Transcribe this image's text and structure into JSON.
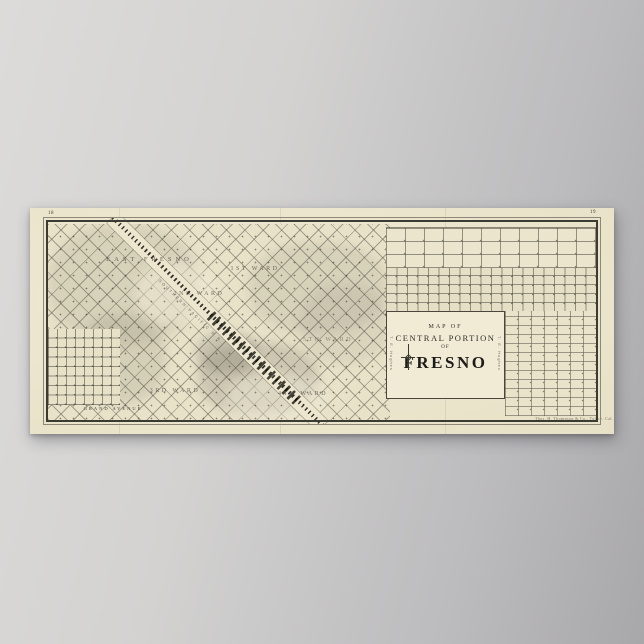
{
  "poster": {
    "page_number_left": "18",
    "page_number_right": "19",
    "imprint": "Thos. H. Thompson & Co., Tulare, Cal."
  },
  "title_box": {
    "line1": "MAP OF",
    "line2": "CENTRAL PORTION",
    "line3": "OF",
    "line4": "FRESNO",
    "side_label_left": "T. E. Hughes",
    "side_label_right": "T. E. Hughes"
  },
  "labels": {
    "wards": [
      {
        "label": "1ST WARD"
      },
      {
        "label": "2ND WARD"
      },
      {
        "label": "3RD WARD"
      },
      {
        "label": "4TH WARD"
      },
      {
        "label": "5TH WARD"
      }
    ],
    "district_east": "EAST FRESNO",
    "street_grand": "GRAND AVENUE",
    "railroad": "SOUTHERN PACIFIC R.R."
  },
  "colors": {
    "wall": "#c8c7c6",
    "paper": "#ebe5cd",
    "ink": "#33322c"
  }
}
